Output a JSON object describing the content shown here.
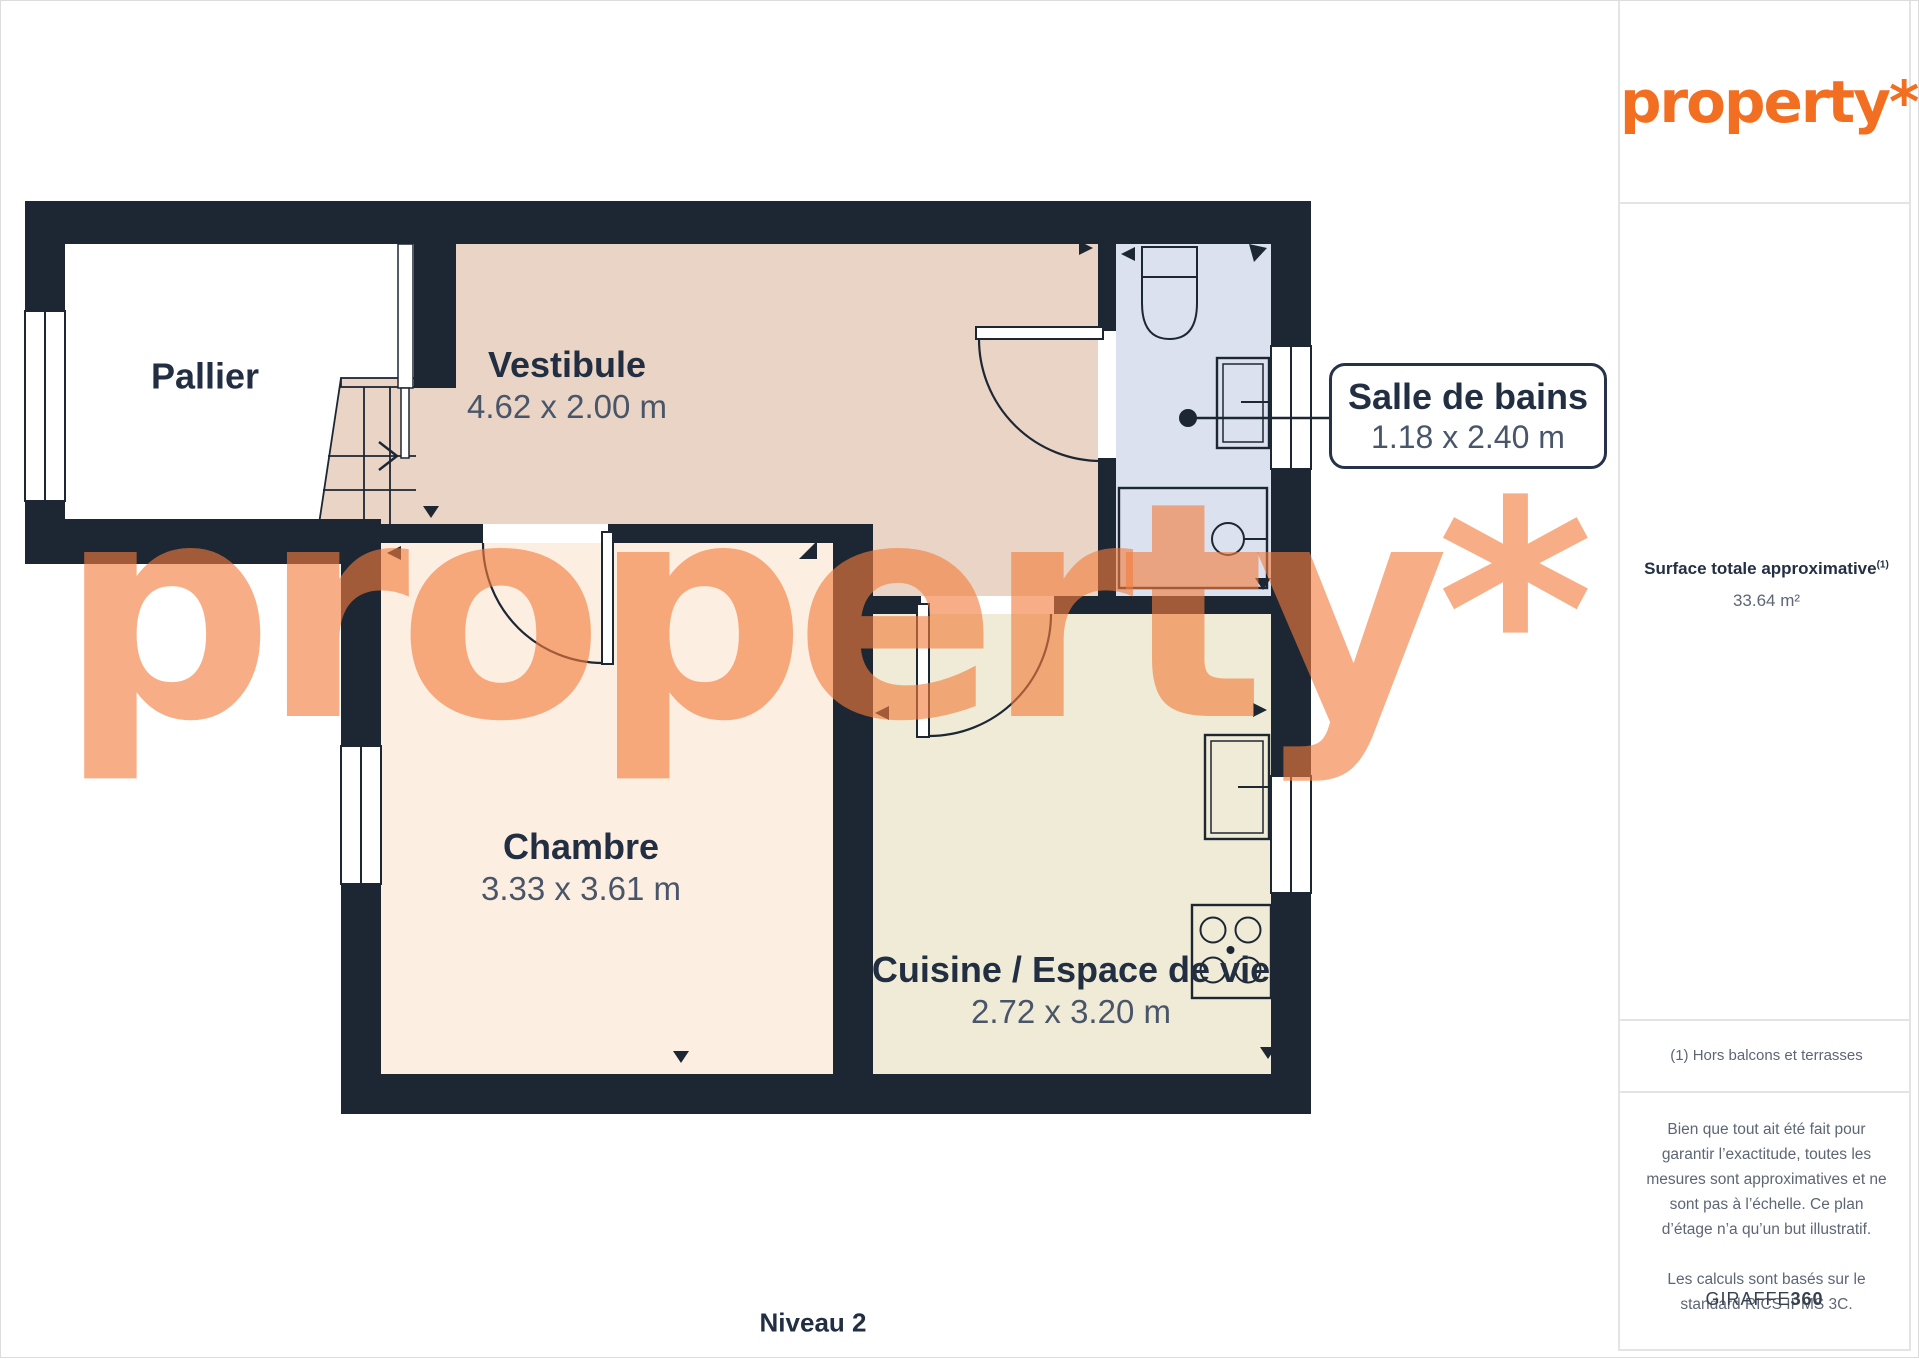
{
  "brand": {
    "logo_text": "property*",
    "accent": "#f26f21"
  },
  "watermark": {
    "text": "property*"
  },
  "plan": {
    "level_label": "Niveau 2",
    "rooms": {
      "pallier": {
        "name": "Pallier"
      },
      "vestibule": {
        "name": "Vestibule",
        "dims": "4.62 x 2.00 m"
      },
      "chambre": {
        "name": "Chambre",
        "dims": "3.33 x 3.61 m"
      },
      "cuisine": {
        "name": "Cuisine / Espace de vie",
        "dims": "2.72 x 3.20 m"
      },
      "salle_de_bains": {
        "name": "Salle de bains",
        "dims": "1.18 x 2.40 m"
      }
    },
    "colors": {
      "wall": "#1d2734",
      "vestibule_floor": "#e9d4c5",
      "chambre_floor": "#fdeee2",
      "cuisine_floor": "#f0ebd6",
      "bathroom_floor": "#dbe1ee",
      "watermark": "rgba(242,125,60,0.62)"
    }
  },
  "sidebar": {
    "surface_label": "Surface totale approximative",
    "surface_sup": "(1)",
    "surface_value": "33.64 m²",
    "footnote": "(1) Hors balcons et terrasses",
    "disclaimer_1": "Bien que tout ait été fait pour garantir l’exactitude, toutes les mesures sont approximatives et ne sont pas à l’échelle. Ce plan d’étage n’a qu’un but illustratif.",
    "disclaimer_2": "Les calculs sont basés sur le standard RICS IPMS 3C.",
    "credit_prefix": "GIRAFFE",
    "credit_suffix": "360"
  }
}
